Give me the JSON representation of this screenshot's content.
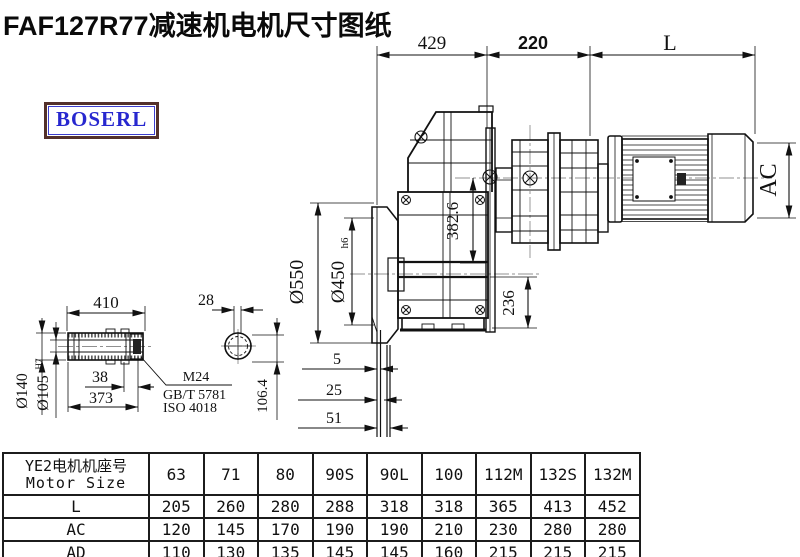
{
  "title": "FAF127R77减速机电机尺寸图纸",
  "logo": "BOSERL",
  "dims": {
    "top_429": "429",
    "top_220": "220",
    "top_L": "L",
    "ac": "AC",
    "dia_550": "Ø550",
    "dia_450": "Ø450",
    "dia_450_suffix": "h6",
    "center_382_6": "382.6",
    "height_236": "236",
    "shaft_410": "410",
    "key_28": "28",
    "dia_140": "Ø140",
    "dia_105": "Ø105",
    "dia_105_suffix": "H7",
    "len_38": "38",
    "len_373": "373",
    "key_106_4": "106.4",
    "wall_5": "5",
    "wall_25": "25",
    "wall_51": "51",
    "bolt_m24": "M24",
    "std_gbt": "GB/T 5781",
    "std_iso": "ISO 4018"
  },
  "table": {
    "header_cn": "YE2电机机座号",
    "header_en": "Motor Size",
    "sizes": [
      "63",
      "71",
      "80",
      "90S",
      "90L",
      "100",
      "112M",
      "132S",
      "132M"
    ],
    "rows": [
      {
        "label": "L",
        "values": [
          "205",
          "260",
          "280",
          "288",
          "318",
          "318",
          "365",
          "413",
          "452"
        ]
      },
      {
        "label": "AC",
        "values": [
          "120",
          "145",
          "170",
          "190",
          "190",
          "210",
          "230",
          "280",
          "280"
        ]
      },
      {
        "label": "AD",
        "values": [
          "110",
          "130",
          "135",
          "145",
          "145",
          "160",
          "215",
          "215",
          "215"
        ]
      }
    ]
  },
  "colors": {
    "line": "#111111",
    "centerline": "#909090",
    "logo_text": "#2727cf",
    "logo_border": "#53302a"
  }
}
